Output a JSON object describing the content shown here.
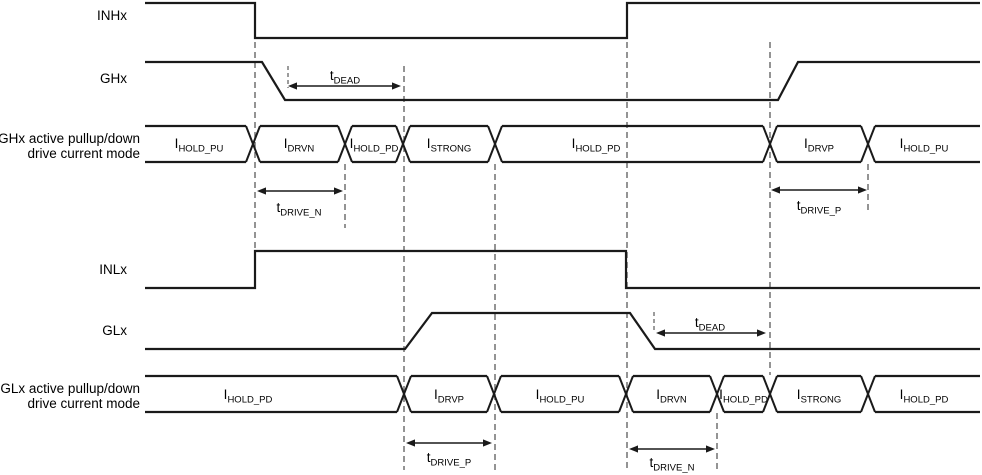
{
  "figure": {
    "width": 982,
    "height": 475,
    "background": "#ffffff"
  },
  "colors": {
    "line": "#1a1a1a",
    "guide": "#666666",
    "text": "#000000"
  },
  "signals": [
    {
      "id": "inhx",
      "label": "INHx",
      "label_x": 127,
      "label_y": 20,
      "points": [
        [
          145,
          3
        ],
        [
          255,
          3
        ],
        [
          255,
          38
        ],
        [
          627,
          38
        ],
        [
          627,
          3
        ],
        [
          980,
          3
        ]
      ]
    },
    {
      "id": "ghx",
      "label": "GHx",
      "label_x": 127,
      "label_y": 83,
      "points": [
        [
          145,
          62
        ],
        [
          262,
          62
        ],
        [
          285,
          100
        ],
        [
          778,
          100
        ],
        [
          798,
          62
        ],
        [
          980,
          62
        ]
      ]
    },
    {
      "id": "inlx",
      "label": "INLx",
      "label_x": 127,
      "label_y": 274,
      "points": [
        [
          145,
          288
        ],
        [
          255,
          288
        ],
        [
          255,
          251
        ],
        [
          626,
          251
        ],
        [
          626,
          288
        ],
        [
          980,
          288
        ]
      ]
    },
    {
      "id": "glx",
      "label": "GLx",
      "label_x": 127,
      "label_y": 335,
      "points": [
        [
          145,
          349
        ],
        [
          405,
          349
        ],
        [
          432,
          313
        ],
        [
          630,
          313
        ],
        [
          655,
          349
        ],
        [
          980,
          349
        ]
      ]
    }
  ],
  "bus_rows": [
    {
      "id": "ghx-mode",
      "label_lines": [
        "GHx active pullup/down",
        "drive current mode"
      ],
      "label_x": 140,
      "label_ys": [
        143,
        158
      ],
      "top": 126,
      "bottom": 162,
      "start": 145,
      "end": 980,
      "label_baseline": 148,
      "transitions": [
        253,
        345,
        403,
        495,
        770,
        868
      ],
      "segments": [
        {
          "main": "I",
          "sub": "HOLD_PU"
        },
        {
          "main": "I",
          "sub": "DRVN"
        },
        {
          "main": "I",
          "sub": "HOLD_PD"
        },
        {
          "main": "I",
          "sub": "STRONG"
        },
        {
          "main": "I",
          "sub": "HOLD_PD",
          "label_x": 596
        },
        {
          "main": "I",
          "sub": "DRVP"
        },
        {
          "main": "I",
          "sub": "HOLD_PU"
        }
      ]
    },
    {
      "id": "glx-mode",
      "label_lines": [
        "GLx active pullup/down",
        "drive current mode"
      ],
      "label_x": 140,
      "label_ys": [
        393,
        408
      ],
      "top": 376,
      "bottom": 412,
      "start": 145,
      "end": 980,
      "label_baseline": 399,
      "transitions": [
        404,
        494,
        626,
        717,
        770,
        868
      ],
      "segments": [
        {
          "main": "I",
          "sub": "HOLD_PD",
          "label_x": 248
        },
        {
          "main": "I",
          "sub": "DRVP"
        },
        {
          "main": "I",
          "sub": "HOLD_PU"
        },
        {
          "main": "I",
          "sub": "DRVN"
        },
        {
          "main": "I",
          "sub": "HOLD_PD"
        },
        {
          "main": "I",
          "sub": "STRONG"
        },
        {
          "main": "I",
          "sub": "HOLD_PD"
        }
      ]
    }
  ],
  "annotations": [
    {
      "id": "tdead-top",
      "main": "t",
      "sub": "DEAD",
      "x1": 288,
      "x2": 401,
      "y": 86,
      "label_x": 345,
      "label_y": 80,
      "tick": {
        "x": 288,
        "y1": 66,
        "y2": 88
      }
    },
    {
      "id": "tdrive-n-top",
      "main": "t",
      "sub": "DRIVE_N",
      "x1": 257,
      "x2": 343,
      "y": 191,
      "label_x": 299,
      "label_y": 212
    },
    {
      "id": "tdrive-p-top",
      "main": "t",
      "sub": "DRIVE_P",
      "x1": 771,
      "x2": 867,
      "y": 190,
      "label_x": 819,
      "label_y": 210
    },
    {
      "id": "tdead-bottom",
      "main": "t",
      "sub": "DEAD",
      "x1": 656,
      "x2": 766,
      "y": 333,
      "label_x": 710,
      "label_y": 327,
      "tick": {
        "x": 654,
        "y1": 312,
        "y2": 332
      }
    },
    {
      "id": "tdrive-p-bottom",
      "main": "t",
      "sub": "DRIVE_P",
      "x1": 406,
      "x2": 492,
      "y": 443,
      "label_x": 449,
      "label_y": 462
    },
    {
      "id": "tdrive-n-bottom",
      "main": "t",
      "sub": "DRIVE_N",
      "x1": 629,
      "x2": 715,
      "y": 449,
      "label_x": 672,
      "label_y": 467
    }
  ],
  "guides": [
    {
      "x": 255,
      "y1": 42,
      "y2": 250
    },
    {
      "x": 345,
      "y1": 164,
      "y2": 228
    },
    {
      "x": 404,
      "y1": 66,
      "y2": 470
    },
    {
      "x": 495,
      "y1": 164,
      "y2": 470
    },
    {
      "x": 627,
      "y1": 42,
      "y2": 470
    },
    {
      "x": 717,
      "y1": 413,
      "y2": 470
    },
    {
      "x": 770,
      "y1": 42,
      "y2": 375
    },
    {
      "x": 868,
      "y1": 164,
      "y2": 212
    }
  ]
}
